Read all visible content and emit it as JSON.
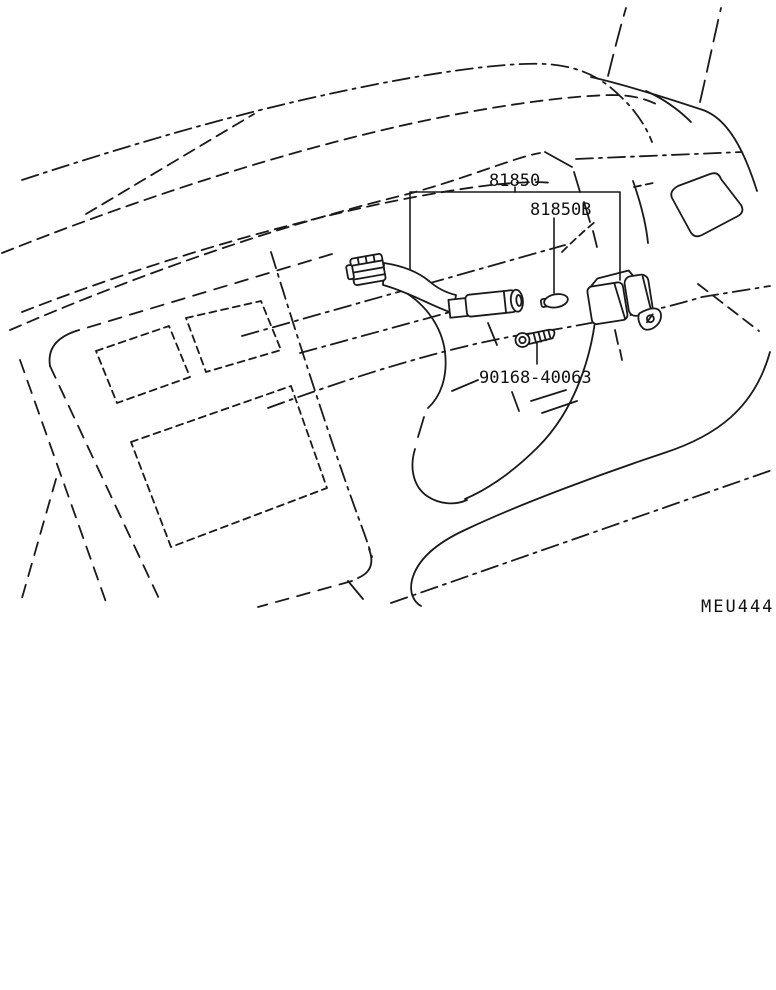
{
  "diagram": {
    "callouts": {
      "harness_label": "81850",
      "grommet_label": "81850B",
      "screw_label": "90168-40063"
    },
    "figure_code": "MEU444",
    "colors": {
      "line": "#1a1a1a",
      "background": "#ffffff"
    }
  }
}
